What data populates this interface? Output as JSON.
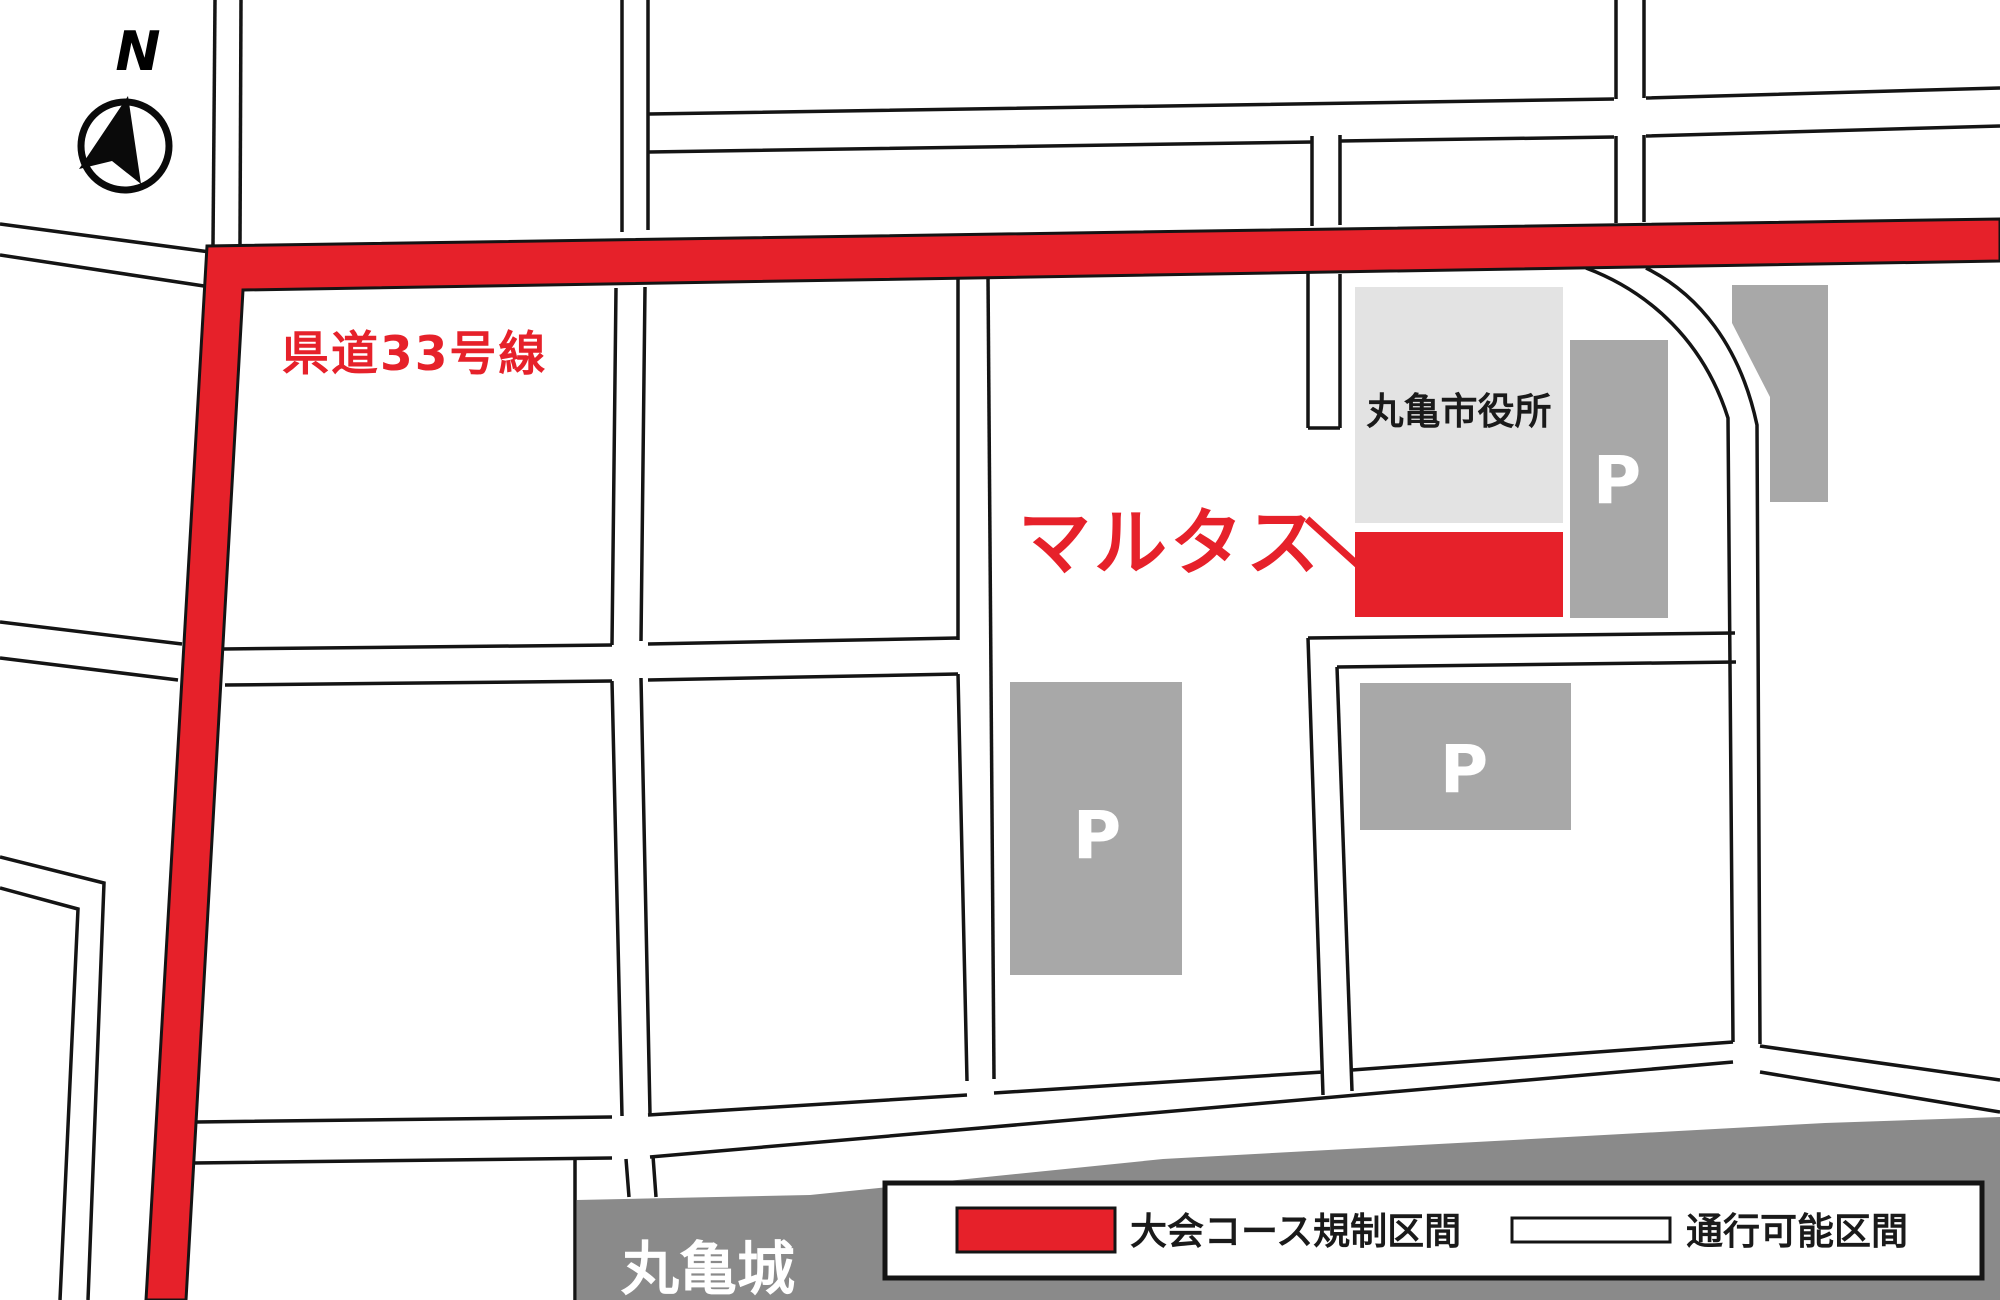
{
  "map": {
    "compass_label": "N",
    "labels": {
      "prefectural_road": "県道33号線",
      "marutas": "マルタス",
      "city_hall": "丸亀市役所",
      "castle": "丸亀城",
      "parking": "P"
    },
    "legend": {
      "restricted": "大会コース規制区間",
      "passable": "通行可能区間"
    },
    "colors": {
      "restricted_red": "#e6212a",
      "road_outline_black": "#141414",
      "parking_gray": "#a8a8a8",
      "city_hall_gray": "#e3e3e3",
      "castle_gray": "#8a8a8a",
      "background_white": "#ffffff"
    }
  }
}
